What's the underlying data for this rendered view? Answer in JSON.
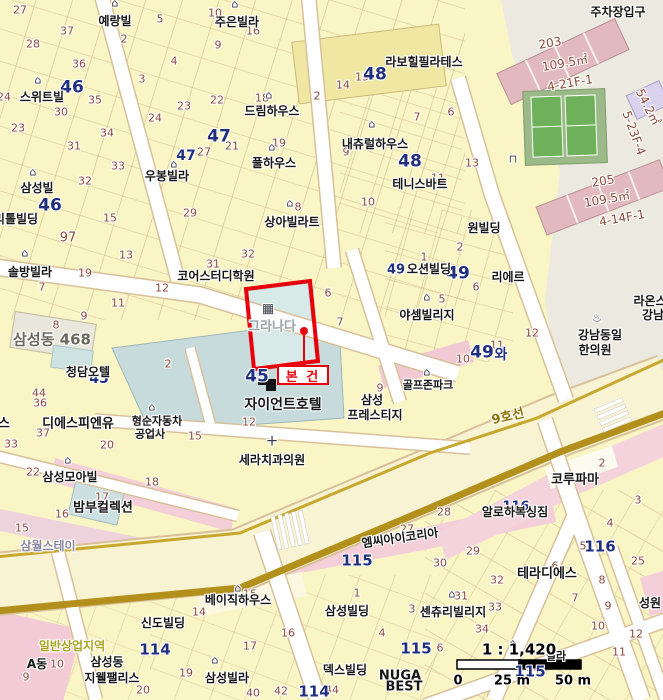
{
  "map": {
    "subject_label": "본 건",
    "subject_building": "그라나다",
    "scale": {
      "ratio": "1 : 1,420",
      "ticks": [
        "0",
        "25 m",
        "50 m"
      ]
    }
  },
  "palette": {
    "accent_red": "#E8000D",
    "navy": "#20307F",
    "brown": "#8C4A3C",
    "gold": "#B3901C",
    "road_casing": "#D8C09A",
    "parcel_yellow": "#F9F5C5",
    "pink_building": "#E2B9BE",
    "pink_strip": "#F4CFD9",
    "gray_zone": "#ECEAE0",
    "blue_building": "#C7DBDD",
    "court_green": "#6FB05A",
    "zone_text": "#A9A41F"
  },
  "labels": [
    {
      "t": "27",
      "x": 20,
      "y": 10,
      "c": "n"
    },
    {
      "t": "37",
      "x": 67,
      "y": 31,
      "c": "n"
    },
    {
      "t": "28",
      "x": 33,
      "y": 44,
      "c": "n"
    },
    {
      "t": "36",
      "x": 79,
      "y": 64,
      "c": "n"
    },
    {
      "t": "35",
      "x": 95,
      "y": 100,
      "c": "n"
    },
    {
      "t": "30",
      "x": 61,
      "y": 112,
      "c": "n"
    },
    {
      "t": "24",
      "x": 4,
      "y": 97,
      "c": "n"
    },
    {
      "t": "23",
      "x": 18,
      "y": 128,
      "c": "n"
    },
    {
      "t": "31",
      "x": 74,
      "y": 146,
      "c": "n"
    },
    {
      "t": "34",
      "x": 107,
      "y": 133,
      "c": "n"
    },
    {
      "t": "33",
      "x": 118,
      "y": 166,
      "c": "n"
    },
    {
      "t": "32",
      "x": 85,
      "y": 181,
      "c": "n"
    },
    {
      "t": "24",
      "x": 155,
      "y": 118,
      "c": "n"
    },
    {
      "t": "23",
      "x": 184,
      "y": 106,
      "c": "n"
    },
    {
      "t": "22",
      "x": 217,
      "y": 100,
      "c": "n"
    },
    {
      "t": "2",
      "x": 124,
      "y": 39,
      "c": "n"
    },
    {
      "t": "5",
      "x": 160,
      "y": 19,
      "c": "n"
    },
    {
      "t": "10",
      "x": 215,
      "y": 13,
      "c": "n"
    },
    {
      "t": "16",
      "x": 253,
      "y": 31,
      "c": "n"
    },
    {
      "t": "9",
      "x": 218,
      "y": 45,
      "c": "n"
    },
    {
      "t": "4",
      "x": 174,
      "y": 61,
      "c": "n"
    },
    {
      "t": "3",
      "x": 142,
      "y": 79,
      "c": "n"
    },
    {
      "t": "27",
      "x": 204,
      "y": 152,
      "c": "n"
    },
    {
      "t": "21",
      "x": 232,
      "y": 146,
      "c": "n"
    },
    {
      "t": "18",
      "x": 262,
      "y": 98,
      "c": "n"
    },
    {
      "t": "19",
      "x": 279,
      "y": 143,
      "c": "n"
    },
    {
      "t": "2",
      "x": 317,
      "y": 96,
      "c": "n"
    },
    {
      "t": "14",
      "x": 343,
      "y": 85,
      "c": "n"
    },
    {
      "t": "15",
      "x": 362,
      "y": 77,
      "c": "n"
    },
    {
      "t": "9",
      "x": 346,
      "y": 152,
      "c": "n"
    },
    {
      "t": "11",
      "x": 438,
      "y": 178,
      "c": "n"
    },
    {
      "t": "10",
      "x": 368,
      "y": 202,
      "c": "n"
    },
    {
      "t": "8",
      "x": 298,
      "y": 207,
      "c": "n"
    },
    {
      "t": "6",
      "x": 451,
      "y": 112,
      "c": "n"
    },
    {
      "t": "13",
      "x": 472,
      "y": 163,
      "c": "n"
    },
    {
      "t": "7",
      "x": 417,
      "y": 117,
      "c": "n"
    },
    {
      "t": "29",
      "x": 190,
      "y": 213,
      "c": "n"
    },
    {
      "t": "15",
      "x": 110,
      "y": 218,
      "c": "n"
    },
    {
      "t": "13",
      "x": 126,
      "y": 255,
      "c": "n"
    },
    {
      "t": "97",
      "x": 68,
      "y": 238,
      "c": "n",
      "s": 13
    },
    {
      "t": "19",
      "x": 85,
      "y": 273,
      "c": "n"
    },
    {
      "t": "7",
      "x": 42,
      "y": 287,
      "c": "n"
    },
    {
      "t": "12",
      "x": 162,
      "y": 288,
      "c": "n"
    },
    {
      "t": "11",
      "x": 118,
      "y": 303,
      "c": "n"
    },
    {
      "t": "9",
      "x": 84,
      "y": 316,
      "c": "n"
    },
    {
      "t": "8",
      "x": 56,
      "y": 325,
      "c": "n"
    },
    {
      "t": "31",
      "x": 213,
      "y": 264,
      "c": "n"
    },
    {
      "t": "32",
      "x": 248,
      "y": 254,
      "c": "n"
    },
    {
      "t": "12",
      "x": 249,
      "y": 422,
      "c": "n"
    },
    {
      "t": "15",
      "x": 195,
      "y": 436,
      "c": "n"
    },
    {
      "t": "2",
      "x": 168,
      "y": 364,
      "c": "n"
    },
    {
      "t": "6",
      "x": 328,
      "y": 293,
      "c": "n"
    },
    {
      "t": "7",
      "x": 340,
      "y": 322,
      "c": "n"
    },
    {
      "t": "9",
      "x": 380,
      "y": 388,
      "c": "n"
    },
    {
      "t": "44",
      "x": 39,
      "y": 393,
      "c": "n"
    },
    {
      "t": "36",
      "x": 40,
      "y": 403,
      "c": "n"
    },
    {
      "t": "37",
      "x": 43,
      "y": 433,
      "c": "n"
    },
    {
      "t": "33",
      "x": 11,
      "y": 444,
      "c": "n"
    },
    {
      "t": "20",
      "x": 107,
      "y": 445,
      "c": "n"
    },
    {
      "t": "22",
      "x": 33,
      "y": 472,
      "c": "n"
    },
    {
      "t": "18",
      "x": 152,
      "y": 482,
      "c": "n"
    },
    {
      "t": "17",
      "x": 102,
      "y": 497,
      "c": "n"
    },
    {
      "t": "16",
      "x": 62,
      "y": 514,
      "c": "n"
    },
    {
      "t": "15",
      "x": 22,
      "y": 528,
      "c": "n"
    },
    {
      "t": "1",
      "x": 424,
      "y": 257,
      "c": "n"
    },
    {
      "t": "2",
      "x": 460,
      "y": 247,
      "c": "n"
    },
    {
      "t": "6",
      "x": 476,
      "y": 287,
      "c": "n"
    },
    {
      "t": "5",
      "x": 442,
      "y": 299,
      "c": "n"
    },
    {
      "t": "12",
      "x": 532,
      "y": 333,
      "c": "n"
    },
    {
      "t": "10",
      "x": 463,
      "y": 359,
      "c": "n"
    },
    {
      "t": "11",
      "x": 497,
      "y": 345,
      "c": "n"
    },
    {
      "t": "2",
      "x": 602,
      "y": 463,
      "c": "n"
    },
    {
      "t": "3",
      "x": 638,
      "y": 500,
      "c": "n"
    },
    {
      "t": "28",
      "x": 444,
      "y": 512,
      "c": "n"
    },
    {
      "t": "27",
      "x": 407,
      "y": 529,
      "c": "n"
    },
    {
      "t": "14",
      "x": 199,
      "y": 612,
      "c": "n"
    },
    {
      "t": "15",
      "x": 250,
      "y": 594,
      "c": "n"
    },
    {
      "t": "1",
      "x": 357,
      "y": 593,
      "c": "n"
    },
    {
      "t": "4",
      "x": 382,
      "y": 633,
      "c": "n"
    },
    {
      "t": "16",
      "x": 288,
      "y": 633,
      "c": "n"
    },
    {
      "t": "17",
      "x": 250,
      "y": 646,
      "c": "n"
    },
    {
      "t": "19",
      "x": 186,
      "y": 673,
      "c": "n"
    },
    {
      "t": "40",
      "x": 253,
      "y": 693,
      "c": "n"
    },
    {
      "t": "42",
      "x": 281,
      "y": 691,
      "c": "n"
    },
    {
      "t": "44",
      "x": 332,
      "y": 690,
      "c": "n"
    },
    {
      "t": "9",
      "x": 26,
      "y": 677,
      "c": "n"
    },
    {
      "t": "10",
      "x": 57,
      "y": 664,
      "c": "n"
    },
    {
      "t": "20",
      "x": 143,
      "y": 690,
      "c": "n"
    },
    {
      "t": "29",
      "x": 473,
      "y": 551,
      "c": "n"
    },
    {
      "t": "30",
      "x": 440,
      "y": 563,
      "c": "n"
    },
    {
      "t": "32",
      "x": 497,
      "y": 580,
      "c": "n"
    },
    {
      "t": "31",
      "x": 461,
      "y": 596,
      "c": "n"
    },
    {
      "t": "33",
      "x": 495,
      "y": 607,
      "c": "n"
    },
    {
      "t": "34",
      "x": 482,
      "y": 629,
      "c": "n"
    },
    {
      "t": "3",
      "x": 412,
      "y": 609,
      "c": "n"
    },
    {
      "t": "6",
      "x": 440,
      "y": 648,
      "c": "n"
    },
    {
      "t": "4",
      "x": 610,
      "y": 523,
      "c": "n"
    },
    {
      "t": "5",
      "x": 583,
      "y": 546,
      "c": "n"
    },
    {
      "t": "25",
      "x": 638,
      "y": 561,
      "c": "n"
    },
    {
      "t": "6",
      "x": 555,
      "y": 566,
      "c": "n"
    },
    {
      "t": "8",
      "x": 602,
      "y": 580,
      "c": "n"
    },
    {
      "t": "7",
      "x": 575,
      "y": 598,
      "c": "n"
    },
    {
      "t": "9",
      "x": 608,
      "y": 606,
      "c": "n"
    },
    {
      "t": "10",
      "x": 598,
      "y": 626,
      "c": "n"
    },
    {
      "t": "12",
      "x": 636,
      "y": 634,
      "c": "n"
    },
    {
      "t": "11",
      "x": 619,
      "y": 652,
      "c": "n"
    },
    {
      "t": "37",
      "x": 533,
      "y": 674,
      "c": "n"
    },
    {
      "t": "46",
      "x": 72,
      "y": 88,
      "c": "B"
    },
    {
      "t": "46",
      "x": 50,
      "y": 206,
      "c": "B"
    },
    {
      "t": "47",
      "x": 219,
      "y": 137,
      "c": "B"
    },
    {
      "t": "47",
      "x": 186,
      "y": 156,
      "c": "B",
      "s": 14
    },
    {
      "t": "48",
      "x": 375,
      "y": 75,
      "c": "B"
    },
    {
      "t": "48",
      "x": 410,
      "y": 162,
      "c": "B"
    },
    {
      "t": "49",
      "x": 458,
      "y": 274,
      "c": "B"
    },
    {
      "t": "49",
      "x": 396,
      "y": 270,
      "c": "B",
      "s": 13
    },
    {
      "t": "49",
      "x": 482,
      "y": 353,
      "c": "B"
    },
    {
      "t": "와",
      "x": 501,
      "y": 355,
      "c": "B",
      "s": 14
    },
    {
      "t": "45",
      "x": 99,
      "y": 379,
      "c": "B",
      "s": 14
    },
    {
      "t": "45",
      "x": 257,
      "y": 377,
      "c": "B"
    },
    {
      "t": "115",
      "x": 357,
      "y": 561,
      "c": "B",
      "s": 15
    },
    {
      "t": "115",
      "x": 416,
      "y": 649,
      "c": "B",
      "s": 15
    },
    {
      "t": "115",
      "x": 530,
      "y": 672,
      "c": "B",
      "s": 15
    },
    {
      "t": "116",
      "x": 516,
      "y": 507,
      "c": "B",
      "s": 13
    },
    {
      "t": "116",
      "x": 600,
      "y": 547,
      "c": "B",
      "s": 15
    },
    {
      "t": "114",
      "x": 155,
      "y": 650,
      "c": "B",
      "s": 15
    },
    {
      "t": "114",
      "x": 314,
      "y": 692,
      "c": "B",
      "s": 15
    },
    {
      "t": "예랑빌",
      "x": 115,
      "y": 21,
      "c": "b"
    },
    {
      "t": "주은빌라",
      "x": 237,
      "y": 22,
      "c": "b"
    },
    {
      "t": "스위트빌",
      "x": 42,
      "y": 97,
      "c": "b"
    },
    {
      "t": "드림하우스",
      "x": 272,
      "y": 111,
      "c": "b"
    },
    {
      "t": "풀하우스",
      "x": 274,
      "y": 163,
      "c": "b"
    },
    {
      "t": "우봉빌라",
      "x": 167,
      "y": 176,
      "c": "b"
    },
    {
      "t": "삼성빌",
      "x": 37,
      "y": 188,
      "c": "b"
    },
    {
      "t": "리톨빌딩",
      "x": 16,
      "y": 219,
      "c": "b"
    },
    {
      "t": "솔방빌라",
      "x": 30,
      "y": 272,
      "c": "b"
    },
    {
      "t": "상아빌라트",
      "x": 292,
      "y": 222,
      "c": "b"
    },
    {
      "t": "내츄럴하우스",
      "x": 375,
      "y": 144,
      "c": "b"
    },
    {
      "t": "테니스바트",
      "x": 420,
      "y": 184,
      "c": "b"
    },
    {
      "t": "라보힐필라테스",
      "x": 424,
      "y": 62,
      "c": "b"
    },
    {
      "t": "코어스터디학원",
      "x": 216,
      "y": 276,
      "c": "b"
    },
    {
      "t": "원빌딩",
      "x": 484,
      "y": 228,
      "c": "b"
    },
    {
      "t": "오션빌딩",
      "x": 429,
      "y": 269,
      "c": "b"
    },
    {
      "t": "리에르",
      "x": 508,
      "y": 277,
      "c": "b"
    },
    {
      "t": "야셈빌리지",
      "x": 427,
      "y": 315,
      "c": "b"
    },
    {
      "t": "골프존파크",
      "x": 428,
      "y": 385,
      "c": "b",
      "s": 11
    },
    {
      "t": "강남동일",
      "x": 600,
      "y": 335,
      "c": "b"
    },
    {
      "t": "한의원",
      "x": 595,
      "y": 350,
      "c": "b"
    },
    {
      "t": "라온스",
      "x": 650,
      "y": 301,
      "c": "b"
    },
    {
      "t": "강남",
      "x": 653,
      "y": 315,
      "c": "b"
    },
    {
      "t": "청담오텔",
      "x": 88,
      "y": 372,
      "c": "b"
    },
    {
      "t": "디에스피엔유",
      "x": 78,
      "y": 424,
      "c": "b",
      "s": 13
    },
    {
      "t": "스",
      "x": 4,
      "y": 424,
      "c": "b",
      "s": 13
    },
    {
      "t": "형순자동차",
      "x": 157,
      "y": 421,
      "c": "b",
      "s": 11
    },
    {
      "t": "공업사",
      "x": 150,
      "y": 434,
      "c": "b",
      "s": 11
    },
    {
      "t": "자이언트호텔",
      "x": 283,
      "y": 405,
      "c": "b",
      "s": 14
    },
    {
      "t": "삼성",
      "x": 372,
      "y": 400,
      "c": "b"
    },
    {
      "t": "프레스티지",
      "x": 375,
      "y": 415,
      "c": "b"
    },
    {
      "t": "세라치과의원",
      "x": 272,
      "y": 460,
      "c": "b"
    },
    {
      "t": "삼성모아빌",
      "x": 70,
      "y": 477,
      "c": "b"
    },
    {
      "t": "밤부컬렉션",
      "x": 103,
      "y": 508,
      "c": "b",
      "s": 13
    },
    {
      "t": "코루파마",
      "x": 575,
      "y": 480,
      "c": "b",
      "s": 13
    },
    {
      "t": "알로하복싱짐",
      "x": 515,
      "y": 512,
      "c": "b"
    },
    {
      "t": "엠씨아이코리아",
      "x": 400,
      "y": 538,
      "c": "b",
      "r": -8
    },
    {
      "t": "베이직하우스",
      "x": 238,
      "y": 600,
      "c": "b"
    },
    {
      "t": "신도빌딩",
      "x": 163,
      "y": 623,
      "c": "b"
    },
    {
      "t": "삼성동",
      "x": 107,
      "y": 662,
      "c": "b"
    },
    {
      "t": "지웰팰리스",
      "x": 112,
      "y": 678,
      "c": "b"
    },
    {
      "t": "삼성빌라",
      "x": 227,
      "y": 678,
      "c": "b"
    },
    {
      "t": "삼성빌딩",
      "x": 347,
      "y": 611,
      "c": "b"
    },
    {
      "t": "덱스빌딩",
      "x": 345,
      "y": 670,
      "c": "b"
    },
    {
      "t": "테라디에스",
      "x": 547,
      "y": 574,
      "c": "b",
      "s": 13
    },
    {
      "t": "센츄리빌리지",
      "x": 453,
      "y": 612,
      "c": "b"
    },
    {
      "t": "성원",
      "x": 650,
      "y": 603,
      "c": "b"
    },
    {
      "t": "빌라",
      "x": 556,
      "y": 656,
      "c": "b",
      "s": 11
    },
    {
      "t": "NUGA",
      "x": 400,
      "y": 676,
      "c": "b",
      "s": 13
    },
    {
      "t": "BEST",
      "x": 404,
      "y": 687,
      "c": "b",
      "s": 13
    },
    {
      "t": "삼월스테이",
      "x": 48,
      "y": 546,
      "c": "v"
    },
    {
      "t": "주차장입구",
      "x": 618,
      "y": 12,
      "c": "b"
    },
    {
      "t": "A동",
      "x": 37,
      "y": 664,
      "c": "b"
    },
    {
      "t": "그라나다",
      "x": 272,
      "y": 327,
      "c": "g"
    },
    {
      "t": "삼성동 468",
      "x": 52,
      "y": 340,
      "c": "d"
    },
    {
      "t": "일반상업지역",
      "x": 72,
      "y": 646,
      "c": "z"
    },
    {
      "t": "9호선",
      "x": 508,
      "y": 417,
      "c": "G",
      "r": -13
    },
    {
      "t": "203",
      "x": 550,
      "y": 43,
      "c": "m",
      "r": -10,
      "s": 12
    },
    {
      "t": "109.5㎡",
      "x": 565,
      "y": 63,
      "c": "m",
      "r": -10,
      "s": 12
    },
    {
      "t": "4-21F-1",
      "x": 570,
      "y": 83,
      "c": "m",
      "r": -10,
      "s": 12
    },
    {
      "t": "205",
      "x": 603,
      "y": 181,
      "c": "m",
      "r": -10,
      "s": 12
    },
    {
      "t": "109.5㎡",
      "x": 607,
      "y": 199,
      "c": "m",
      "r": -10,
      "s": 12
    },
    {
      "t": "4-14F-1",
      "x": 622,
      "y": 218,
      "c": "m",
      "r": -10,
      "s": 12
    },
    {
      "t": "54.2㎡",
      "x": 648,
      "y": 107,
      "c": "m",
      "r": 63,
      "s": 12
    },
    {
      "t": "5-23F-4",
      "x": 634,
      "y": 133,
      "c": "m",
      "r": 70,
      "s": 12
    },
    {
      "t": "⌂",
      "x": 115,
      "y": 3,
      "c": "i",
      "n": "house-icon"
    },
    {
      "t": "⌂",
      "x": 235,
      "y": 4,
      "c": "i",
      "n": "house-icon"
    },
    {
      "t": "⌂",
      "x": 38,
      "y": 80,
      "c": "i",
      "n": "house-icon"
    },
    {
      "t": "⌂",
      "x": 33,
      "y": 172,
      "c": "i",
      "n": "house-icon"
    },
    {
      "t": "⌂",
      "x": 25,
      "y": 253,
      "c": "i",
      "n": "house-icon"
    },
    {
      "t": "⌂",
      "x": 174,
      "y": 164,
      "c": "i",
      "n": "house-icon"
    },
    {
      "t": "⌂",
      "x": 269,
      "y": 95,
      "c": "i",
      "n": "house-icon"
    },
    {
      "t": "⌂",
      "x": 272,
      "y": 147,
      "c": "i",
      "n": "house-icon"
    },
    {
      "t": "⌂",
      "x": 372,
      "y": 124,
      "c": "i",
      "n": "house-icon"
    },
    {
      "t": "⌂",
      "x": 290,
      "y": 203,
      "c": "i",
      "n": "house-icon"
    },
    {
      "t": "⌂",
      "x": 427,
      "y": 297,
      "c": "i",
      "n": "house-icon"
    },
    {
      "t": "⌂",
      "x": 68,
      "y": 460,
      "c": "i",
      "n": "house-icon"
    },
    {
      "t": "⌂",
      "x": 215,
      "y": 660,
      "c": "i",
      "n": "house-icon"
    },
    {
      "t": "⌂",
      "x": 238,
      "y": 588,
      "c": "i",
      "n": "shop-icon"
    },
    {
      "t": "⌂",
      "x": 452,
      "y": 594,
      "c": "i",
      "n": "house-icon"
    },
    {
      "t": "⌂",
      "x": 513,
      "y": 643,
      "c": "i",
      "n": "house-icon"
    },
    {
      "t": "♨",
      "x": 597,
      "y": 318,
      "c": "i",
      "n": "oriental-clinic-icon"
    },
    {
      "t": "⌂",
      "x": 152,
      "y": 407,
      "c": "i",
      "n": "car-repair-icon"
    },
    {
      "t": "+",
      "x": 272,
      "y": 441,
      "c": "i",
      "n": "hospital-cross-icon",
      "s": 15
    },
    {
      "t": "⌂",
      "x": 427,
      "y": 372,
      "c": "i",
      "n": "golf-icon"
    },
    {
      "t": "⊓",
      "x": 513,
      "y": 159,
      "c": "i",
      "n": "parking-entrance-icon"
    },
    {
      "t": "▦",
      "x": 268,
      "y": 309,
      "c": "i",
      "n": "building-icon",
      "s": 13
    }
  ]
}
